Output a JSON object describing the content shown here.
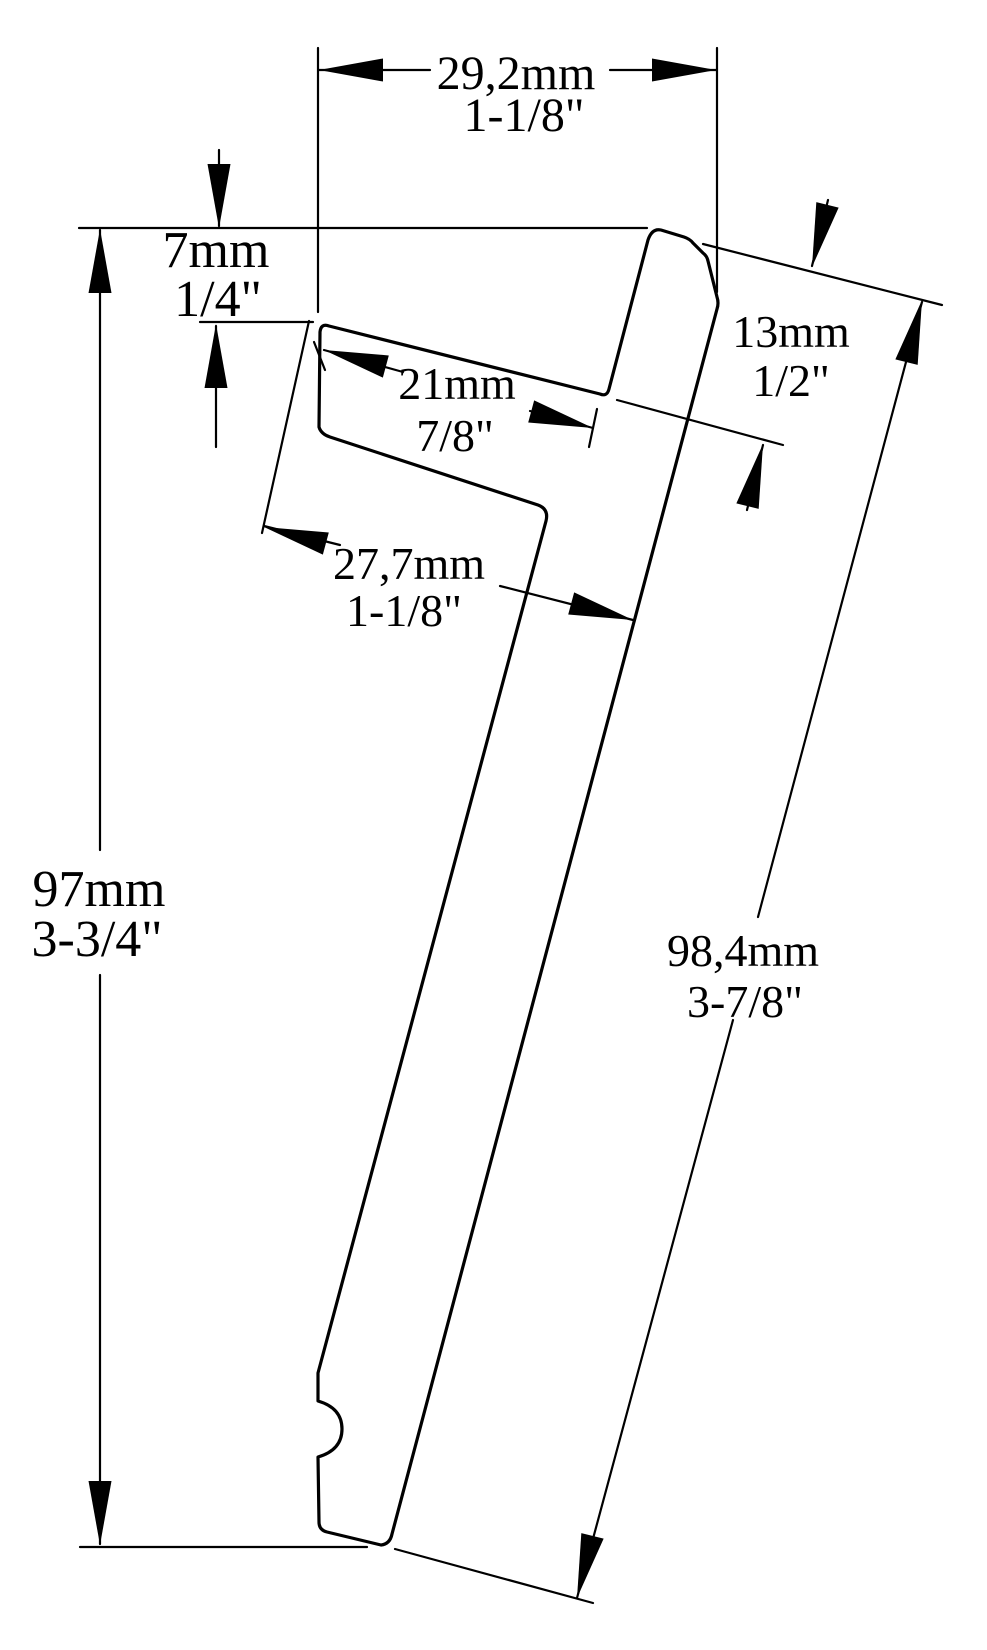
{
  "diagram": {
    "colors": {
      "line": "#000000",
      "text": "#000000",
      "background": "#ffffff"
    },
    "dims": [
      {
        "id": "top-width",
        "metric": "29,2mm",
        "imperial": "1-1/8\""
      },
      {
        "id": "lip-drop",
        "metric": "7mm",
        "imperial": "1/4\""
      },
      {
        "id": "slot-depth",
        "metric": "21mm",
        "imperial": "7/8\""
      },
      {
        "id": "head-thickness",
        "metric": "13mm",
        "imperial": "1/2\""
      },
      {
        "id": "hook-depth",
        "metric": "27,7mm",
        "imperial": "1-1/8\""
      },
      {
        "id": "overall-height",
        "metric": "97mm",
        "imperial": "3-3/4\""
      },
      {
        "id": "leg-length",
        "metric": "98,4mm",
        "imperial": "3-7/8\""
      }
    ]
  }
}
